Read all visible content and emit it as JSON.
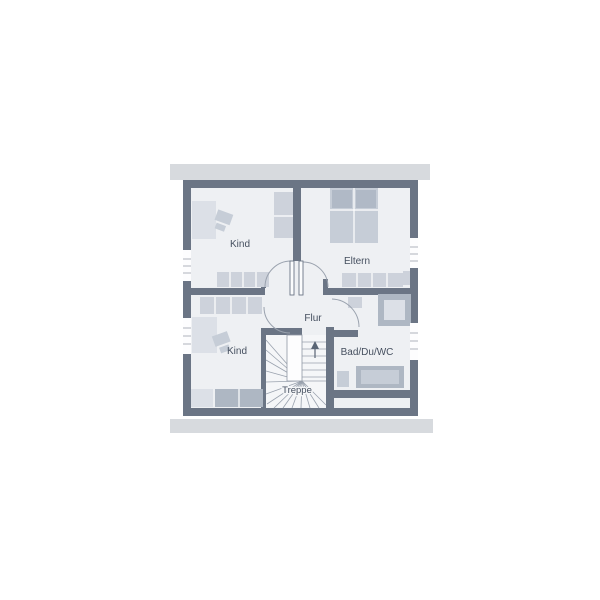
{
  "plan": {
    "type": "floor-plan",
    "rooms": {
      "kind_top": {
        "label": "Kind"
      },
      "eltern": {
        "label": "Eltern"
      },
      "flur": {
        "label": "Flur"
      },
      "kind_bottom": {
        "label": "Kind"
      },
      "bad": {
        "label": "Bad/Du/WC"
      },
      "treppe": {
        "label": "Treppe"
      }
    }
  },
  "colors": {
    "wall": "#6b7585",
    "floor": "#eef0f3",
    "eaves_bar": "#d7dade",
    "furniture_light": "#dce0e7",
    "furniture_mid": "#c6cdd7",
    "furniture_wardrobe": "#cdd2db",
    "furniture_dark": "#aeb7c3",
    "label_text": "#454f5f",
    "background": "#ffffff"
  }
}
